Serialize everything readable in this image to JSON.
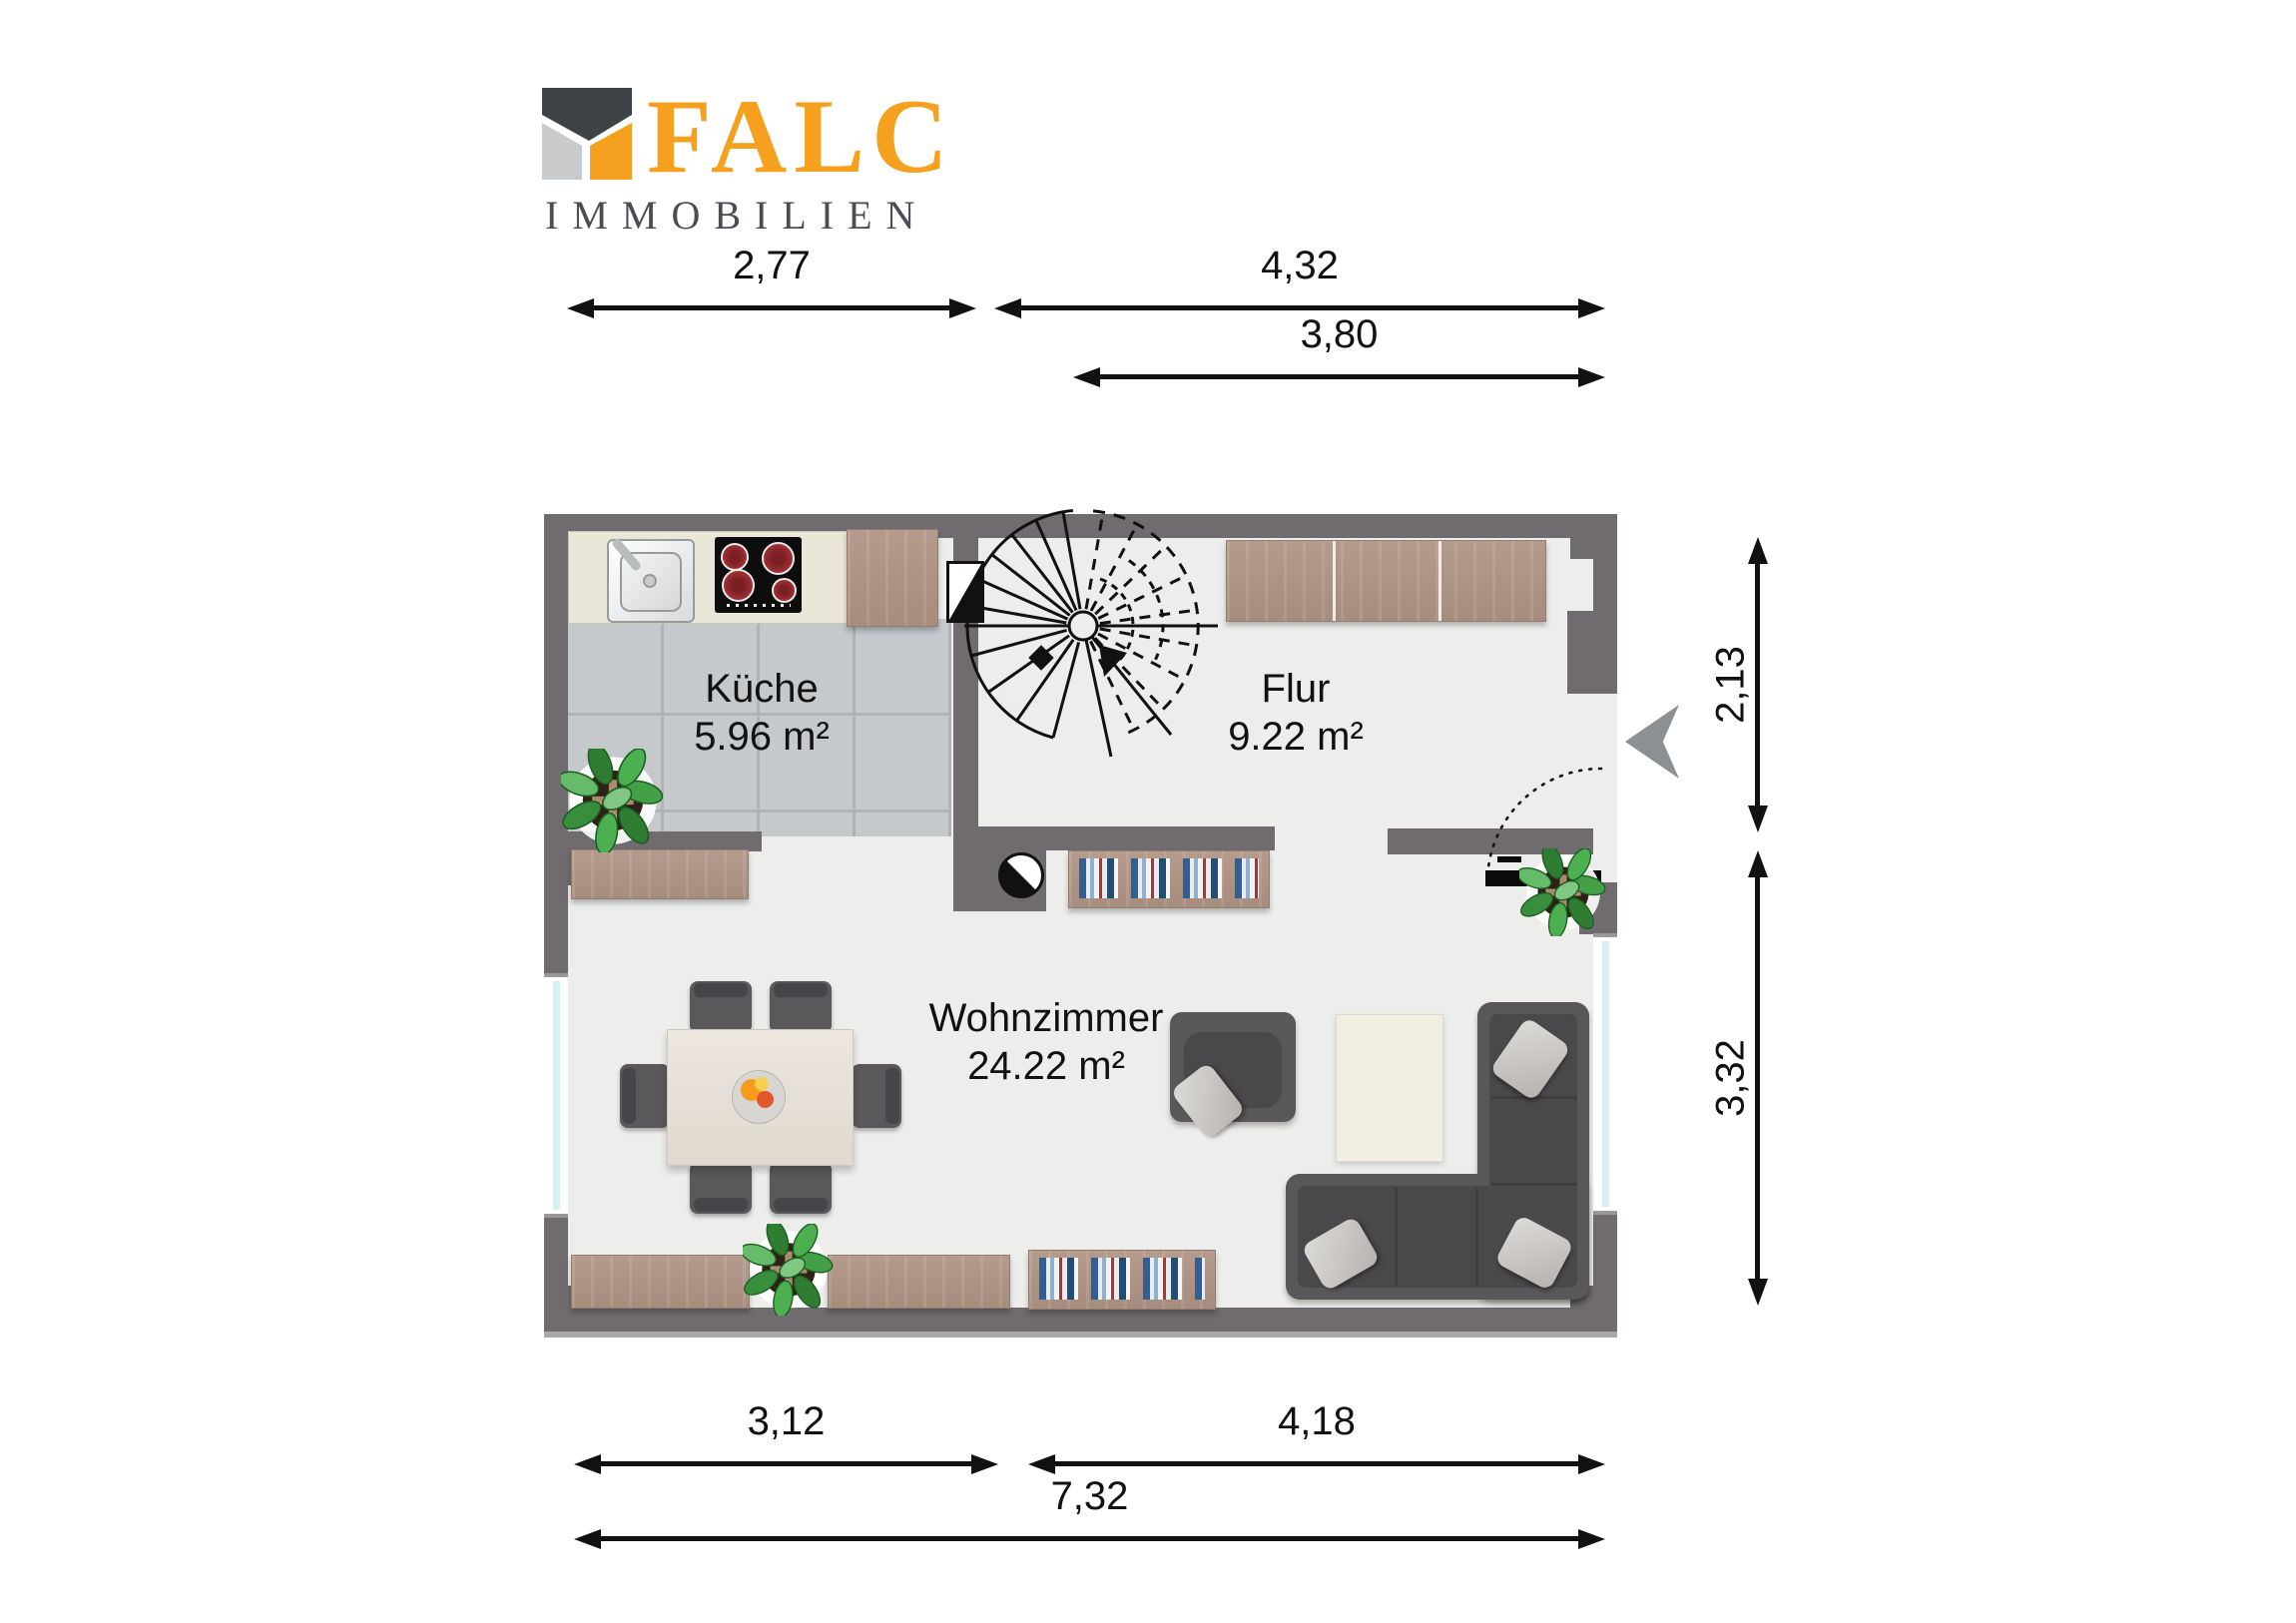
{
  "logo": {
    "brand": "FALC",
    "subtitle": "IMMOBILIEN"
  },
  "rooms": {
    "kueche": {
      "name": "Küche",
      "area": "5.96 m²"
    },
    "flur": {
      "name": "Flur",
      "area": "9.22 m²"
    },
    "wohnzimmer": {
      "name": "Wohnzimmer",
      "area": "24.22 m²"
    }
  },
  "dimensions": {
    "d277": {
      "label": "2,77"
    },
    "d432": {
      "label": "4,32"
    },
    "d380": {
      "label": "3,80"
    },
    "d213": {
      "label": "2,13"
    },
    "d332": {
      "label": "3,32"
    },
    "d312": {
      "label": "3,12"
    },
    "d418": {
      "label": "4,18"
    },
    "d732": {
      "label": "7,32"
    }
  },
  "icons": {
    "logo_house_icon": "stylized house split in roof / grey / orange panels",
    "entrance_arrow_icon": "grey chevron pointing left at entry door",
    "spiral_stair_icon": "spiral staircase plan symbol",
    "stove_icon": "black-white split circle on wall block",
    "chimney_icon": "black-white diagonal rectangle on kitchen wall",
    "plant_icon": "potted plant top view",
    "door_swing_icon": "dotted quarter-arc with black door leaf"
  },
  "colors": {
    "wall": "#6F6B6F",
    "floor": "#EDEEEC",
    "tile": "#C5C9CC",
    "tile_line": "#AFB3B7",
    "wood_light": "#B59B8B",
    "wood_dark": "#A68C7C",
    "counter": "#EAE6D8",
    "sofa": "#5A575A",
    "sofa_seat": "#4B484B",
    "pillow": "#CFCDCA",
    "table": "#EAE5DD",
    "rug": "#F2EEE2",
    "glass": "#D8EFF5",
    "text": "#111111",
    "brand": "#F5A01E",
    "subtitle": "#4A4E54",
    "arrow": "#8D9093"
  }
}
